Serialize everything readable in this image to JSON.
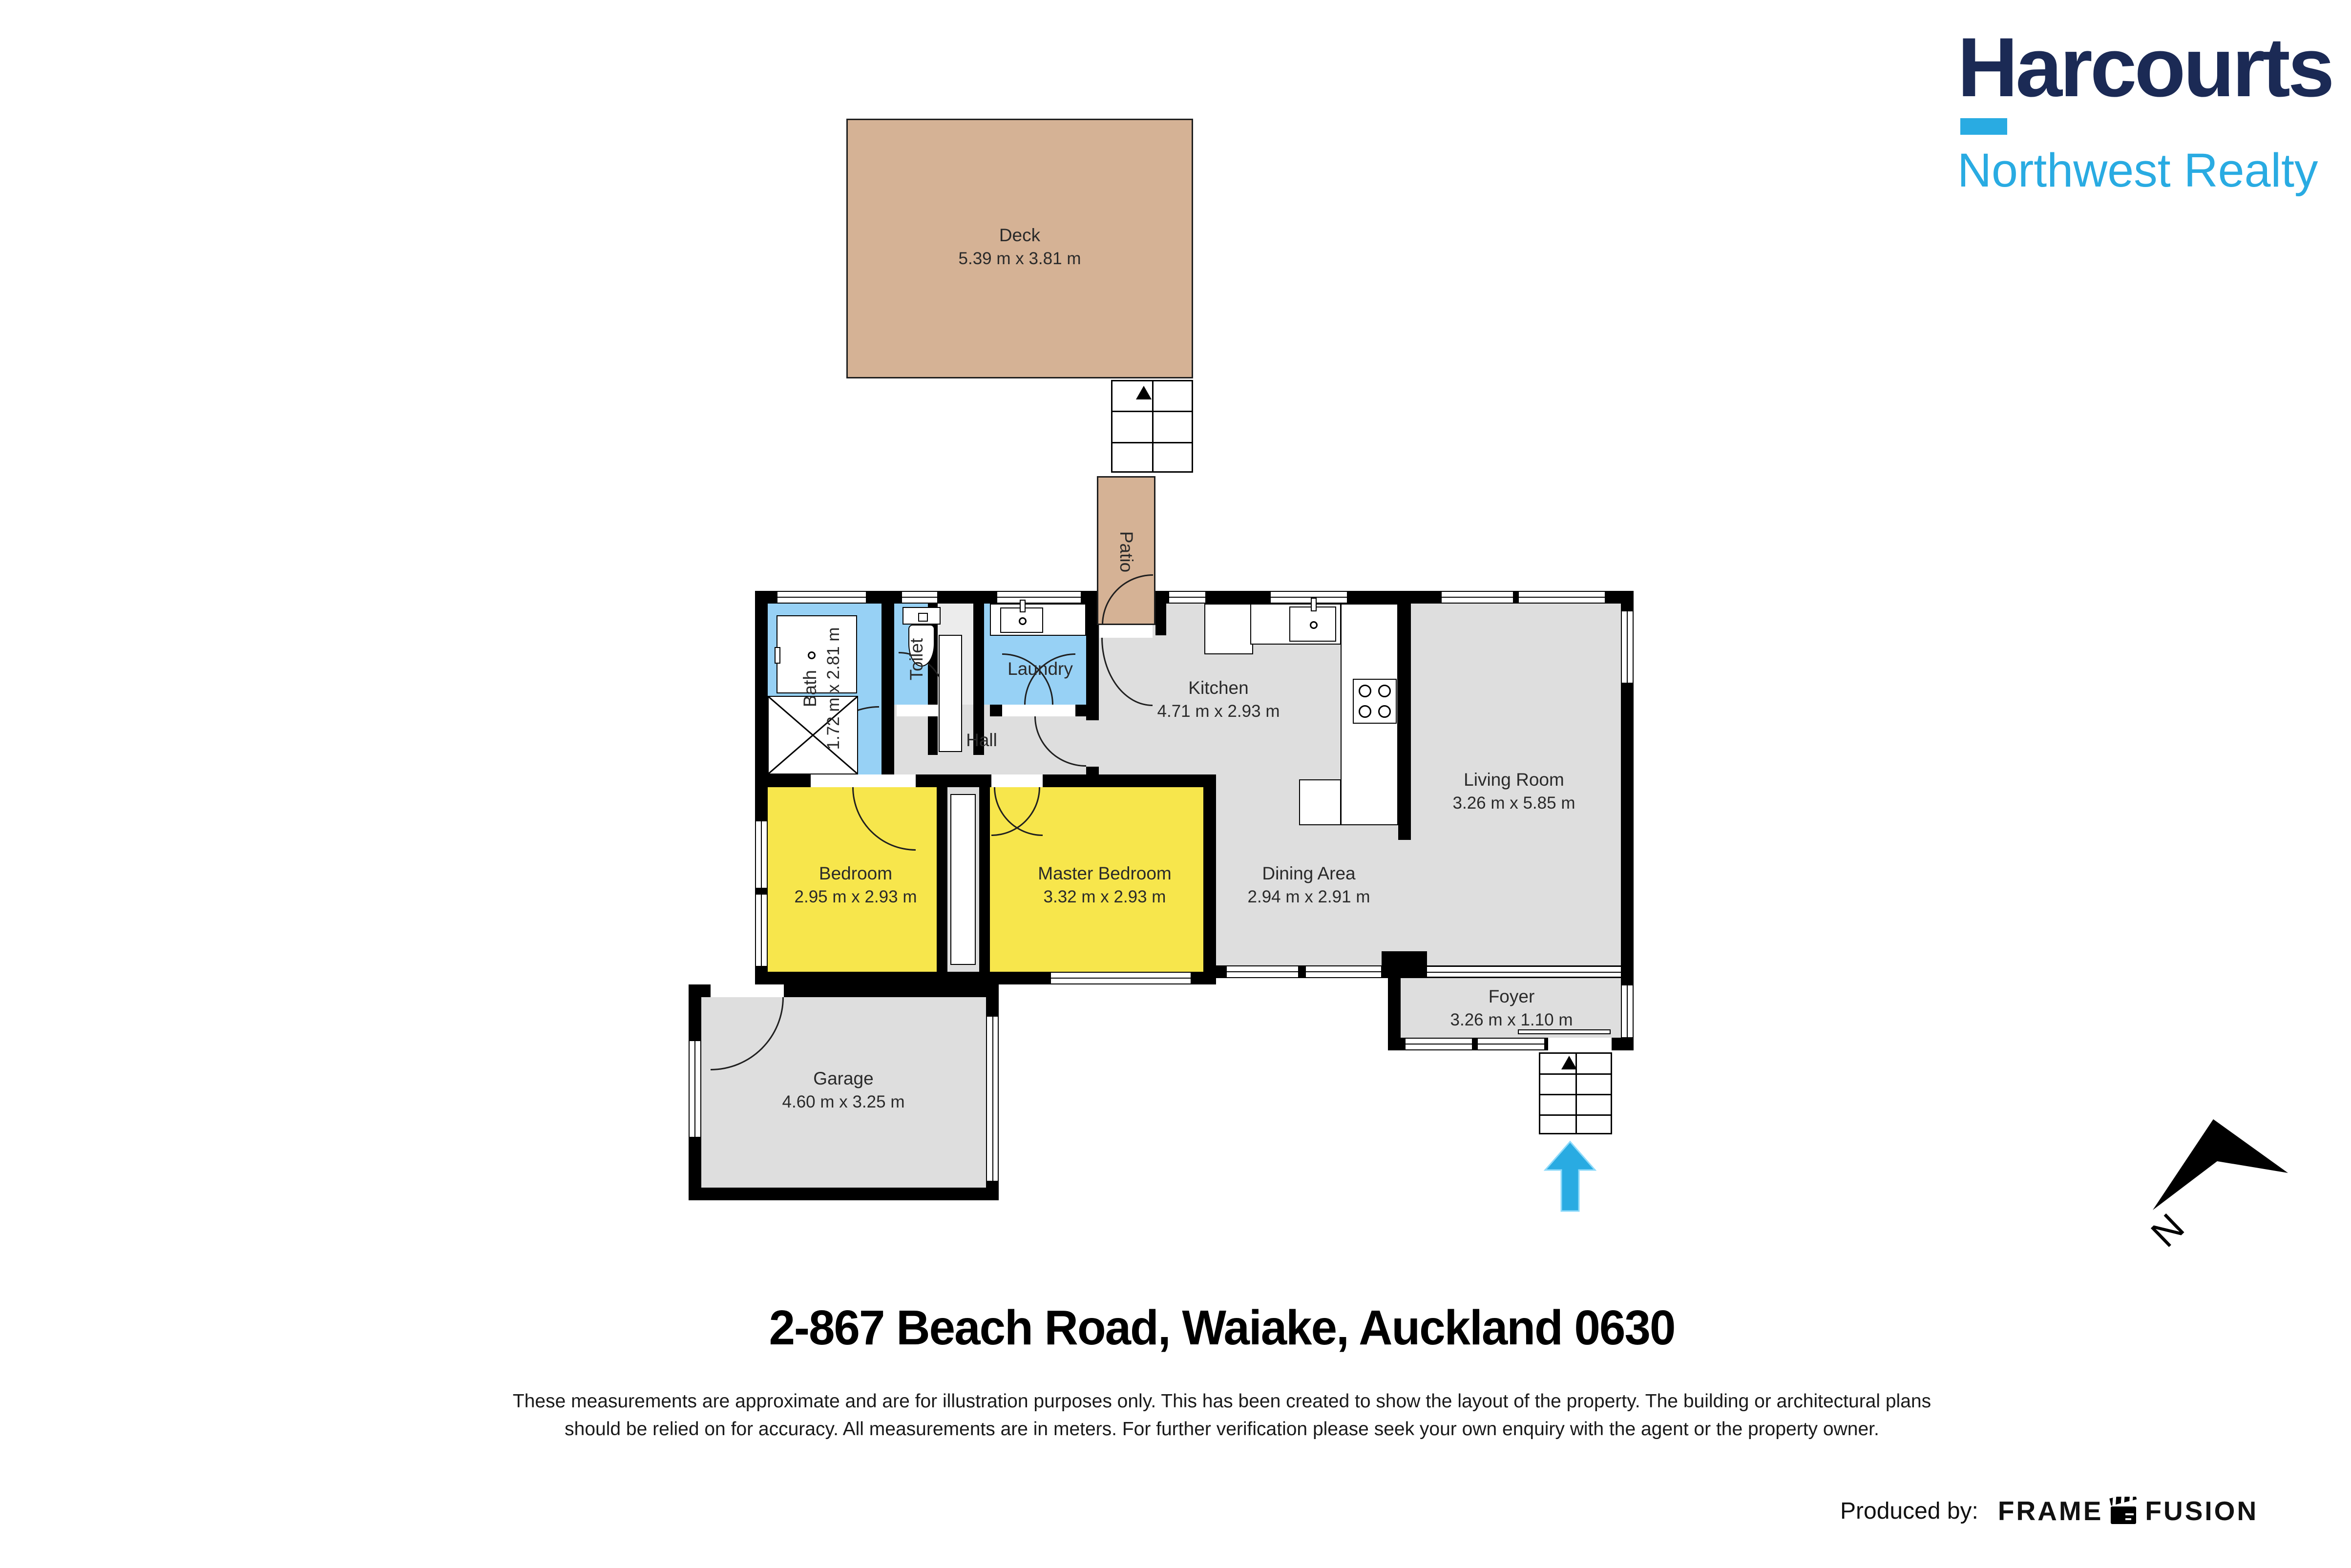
{
  "logo": {
    "brand": "Harcourts",
    "sub": "Northwest Realty"
  },
  "colors": {
    "navy": "#1b2a55",
    "sky": "#29abe2",
    "tan": "#d5b295",
    "blue_room": "#97d1f5",
    "yellow_room": "#f7e64c",
    "gray_room": "#dedede",
    "wall": "#000000"
  },
  "rooms": [
    {
      "name": "Deck",
      "dims": "5.39 m x 3.81 m"
    },
    {
      "name": "Patio",
      "dims": ""
    },
    {
      "name": "Bath",
      "dims": "1.72 m x 2.81 m"
    },
    {
      "name": "Toilet",
      "dims": ""
    },
    {
      "name": "Laundry",
      "dims": ""
    },
    {
      "name": "Hall",
      "dims": ""
    },
    {
      "name": "Kitchen",
      "dims": "4.71 m x 2.93 m"
    },
    {
      "name": "Living Room",
      "dims": "3.26 m x 5.85 m"
    },
    {
      "name": "Bedroom",
      "dims": "2.95 m x 2.93 m"
    },
    {
      "name": "Master Bedroom",
      "dims": "3.32 m x 2.93 m"
    },
    {
      "name": "Dining Area",
      "dims": "2.94 m x 2.91 m"
    },
    {
      "name": "Foyer",
      "dims": "3.26 m x 1.10 m"
    },
    {
      "name": "Garage",
      "dims": "4.60 m x 3.25 m"
    }
  ],
  "compass": {
    "label": "N"
  },
  "footer": {
    "address": "2-867 Beach Road, Waiake,  Auckland 0630",
    "disclaimer": "These measurements are approximate and are for illustration purposes only. This has been created to show the layout of the property. The building or architectural plans should be relied on for accuracy. All measurements are in meters. For further verification please seek your own enquiry with the agent or the property owner.",
    "produced_by": "Produced by:",
    "producer_word1": "FRAME",
    "producer_word2": "FUSION"
  }
}
